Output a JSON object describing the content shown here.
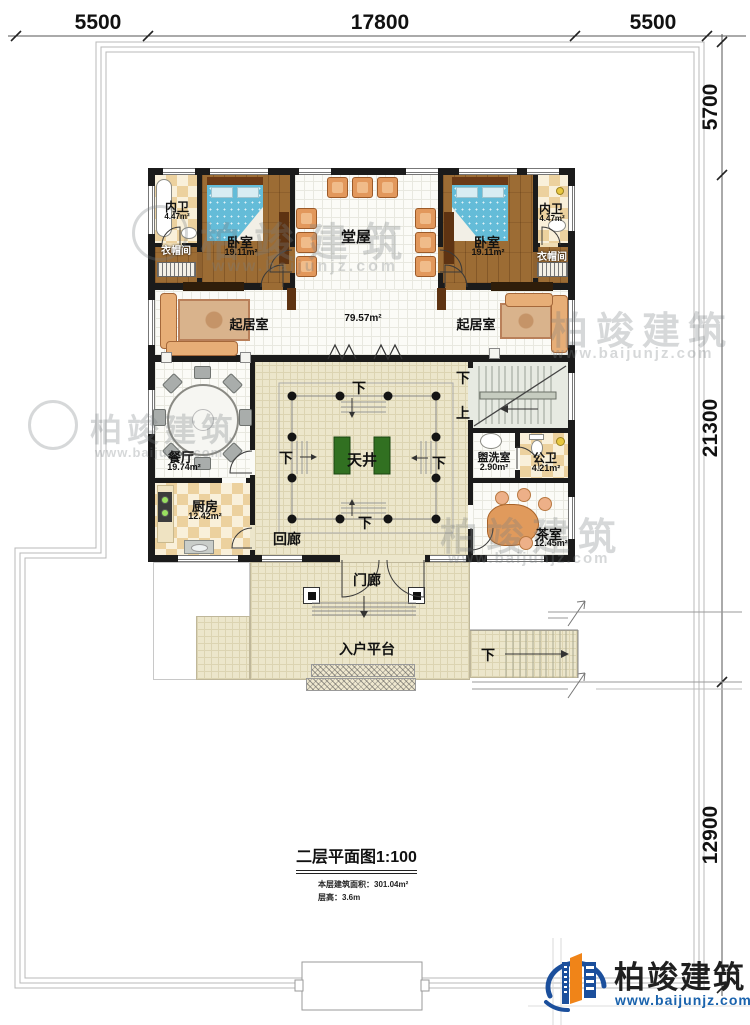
{
  "dims": {
    "top": [
      "5500",
      "17800",
      "5500"
    ],
    "right": [
      "5700",
      "21300",
      "12900"
    ]
  },
  "rooms": {
    "neiwei_l": {
      "label": "内卫",
      "area": "4.47m²"
    },
    "cloak_l": {
      "label": "衣帽间"
    },
    "bedroom_l": {
      "label": "卧室",
      "area": "19.11m²"
    },
    "tangwu": {
      "label": "堂屋"
    },
    "bedroom_r": {
      "label": "卧室",
      "area": "19.11m²"
    },
    "neiwei_r": {
      "label": "内卫",
      "area": "4.47m²"
    },
    "cloak_r": {
      "label": "衣帽间"
    },
    "living_l": {
      "label": "起居室"
    },
    "living_r": {
      "label": "起居室"
    },
    "open": {
      "area": "79.57m²"
    },
    "dining": {
      "label": "餐厅",
      "area": "19.74m²"
    },
    "kitchen": {
      "label": "厨房",
      "area": "12.42m²"
    },
    "tianjing": {
      "label": "天井"
    },
    "huilang": {
      "label": "回廊"
    },
    "washroom": {
      "label": "盥洗室",
      "area": "2.90m²"
    },
    "gongwei": {
      "label": "公卫",
      "area": "4.21m²"
    },
    "tearoom": {
      "label": "茶室",
      "area": "12.45m²"
    },
    "porch": {
      "label": "门廊"
    },
    "platform": {
      "label": "入户平台"
    }
  },
  "stairs": {
    "down": "下",
    "up": "上"
  },
  "title": {
    "main": "二层平面图1:100",
    "area_line": "本层建筑面积：301.04m²",
    "height_line": "层高：3.6m"
  },
  "logo": {
    "name": "柏竣建筑",
    "site": "www.baijunjz.com"
  },
  "colors": {
    "wall": "#1b1b1b",
    "corridor_floor": "#ece6cb",
    "wood_floor": "#9c6c34",
    "bed_blue": "#64bcd8",
    "chair_orange": "#e2985c",
    "planter_green": "#317021",
    "logo_blue": "#1b4f9c",
    "logo_orange": "#f08418",
    "site_link_blue": "#1a63ad"
  }
}
